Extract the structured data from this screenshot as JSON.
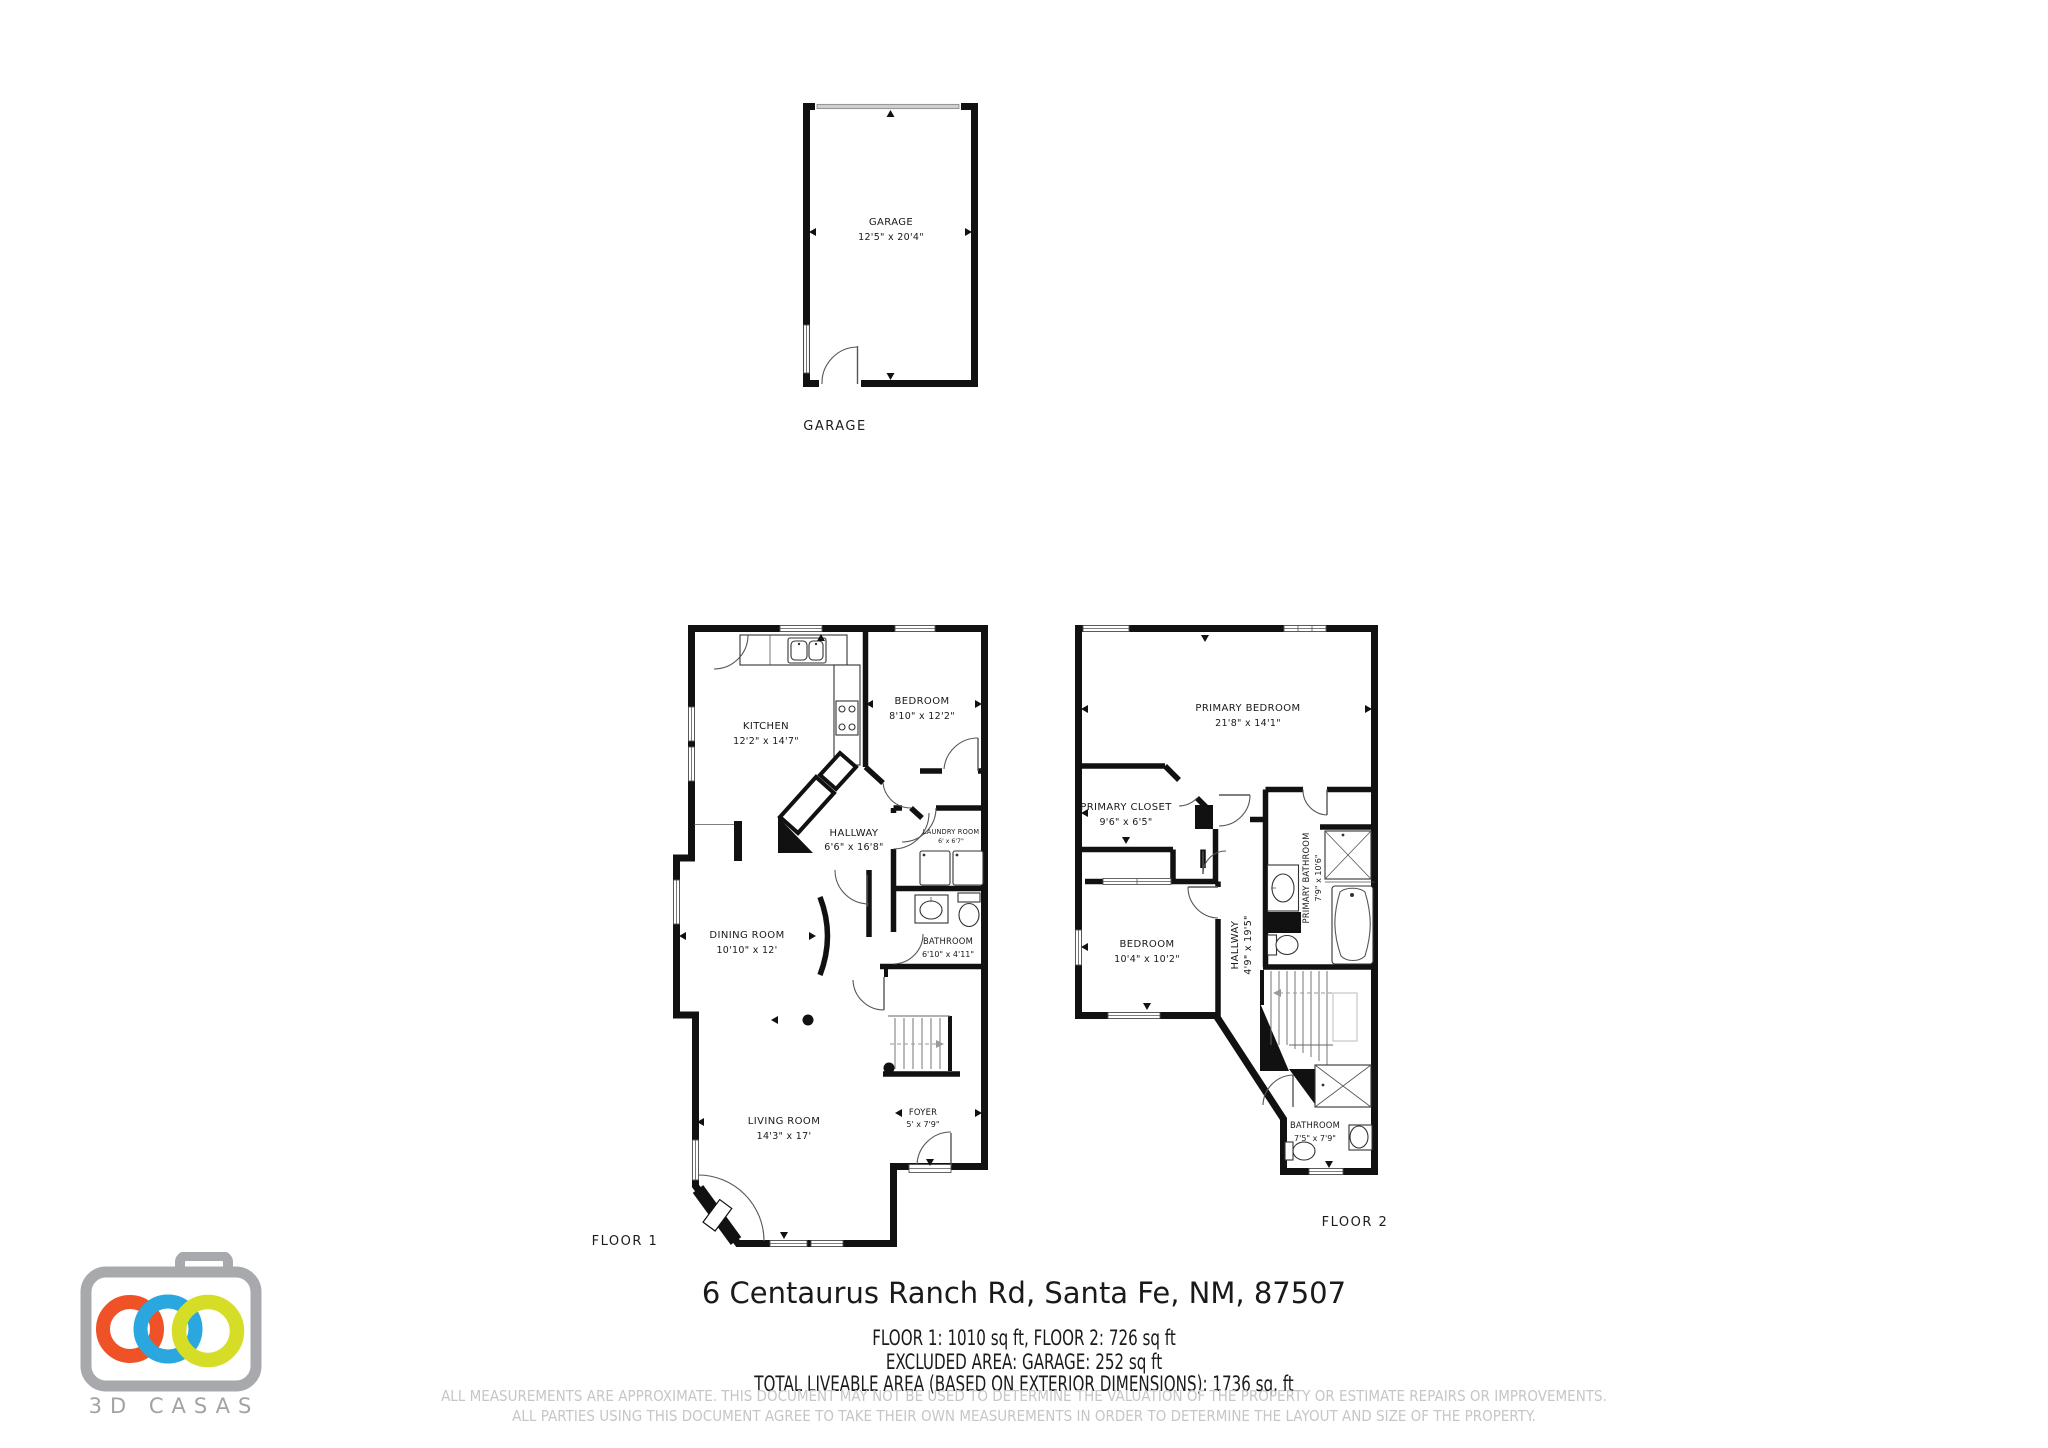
{
  "page": {
    "background": "#ffffff",
    "wall_color": "#111111",
    "disclaimer_color": "#c6c6c6"
  },
  "plans": {
    "garage": {
      "caption": "GARAGE",
      "rooms": {
        "garage": {
          "name": "GARAGE",
          "dims": "12'5\" x 20'4\""
        }
      }
    },
    "floor1": {
      "caption": "FLOOR 1",
      "rooms": {
        "kitchen": {
          "name": "KITCHEN",
          "dims": "12'2\" x 14'7\""
        },
        "bedroom": {
          "name": "BEDROOM",
          "dims": "8'10\" x 12'2\""
        },
        "hallway": {
          "name": "HALLWAY",
          "dims": "6'6\" x 16'8\""
        },
        "laundry": {
          "name": "LAUNDRY ROOM",
          "dims": "6' x 6'7\""
        },
        "dining": {
          "name": "DINING ROOM",
          "dims": "10'10\" x 12'"
        },
        "bathroom": {
          "name": "BATHROOM",
          "dims": "6'10\" x 4'11\""
        },
        "living": {
          "name": "LIVING ROOM",
          "dims": "14'3\" x 17'"
        },
        "foyer": {
          "name": "FOYER",
          "dims": "5' x 7'9\""
        }
      }
    },
    "floor2": {
      "caption": "FLOOR 2",
      "rooms": {
        "primary_bedroom": {
          "name": "PRIMARY BEDROOM",
          "dims": "21'8\" x 14'1\""
        },
        "primary_closet": {
          "name": "PRIMARY CLOSET",
          "dims": "9'6\" x 6'5\""
        },
        "bedroom": {
          "name": "BEDROOM",
          "dims": "10'4\" x 10'2\""
        },
        "hallway": {
          "name": "HALLWAY",
          "dims": "4'9\" x 19'5\""
        },
        "primary_bathroom": {
          "name": "PRIMARY BATHROOM",
          "dims": "7'9\" x 10'6\""
        },
        "bathroom": {
          "name": "BATHROOM",
          "dims": "7'5\" x 7'9\""
        }
      }
    }
  },
  "footer": {
    "address": "6 Centaurus Ranch Rd, Santa Fe, NM, 87507",
    "line1": "FLOOR 1: 1010 sq ft, FLOOR 2: 726 sq ft",
    "line2": "EXCLUDED AREA: GARAGE: 252 sq ft",
    "line3": "TOTAL LIVEABLE AREA (BASED ON EXTERIOR DIMENSIONS): 1736 sq. ft",
    "disclaimer1": "ALL MEASUREMENTS ARE APPROXIMATE. THIS DOCUMENT MAY NOT BE USED TO DETERMINE THE VALUATION OF THE PROPERTY OR ESTIMATE REPAIRS OR IMPROVEMENTS.",
    "disclaimer2": "ALL PARTIES USING THIS DOCUMENT AGREE TO TAKE THEIR OWN MEASUREMENTS IN ORDER TO DETERMINE THE LAYOUT AND SIZE OF THE PROPERTY."
  },
  "logo": {
    "brand": "3D CASAS",
    "camera_color": "#A7A9AC",
    "ring_orange": "#EF5226",
    "ring_blue": "#2AA7DF",
    "ring_green": "#D5DD27",
    "text_color": "#A0A2A5"
  }
}
